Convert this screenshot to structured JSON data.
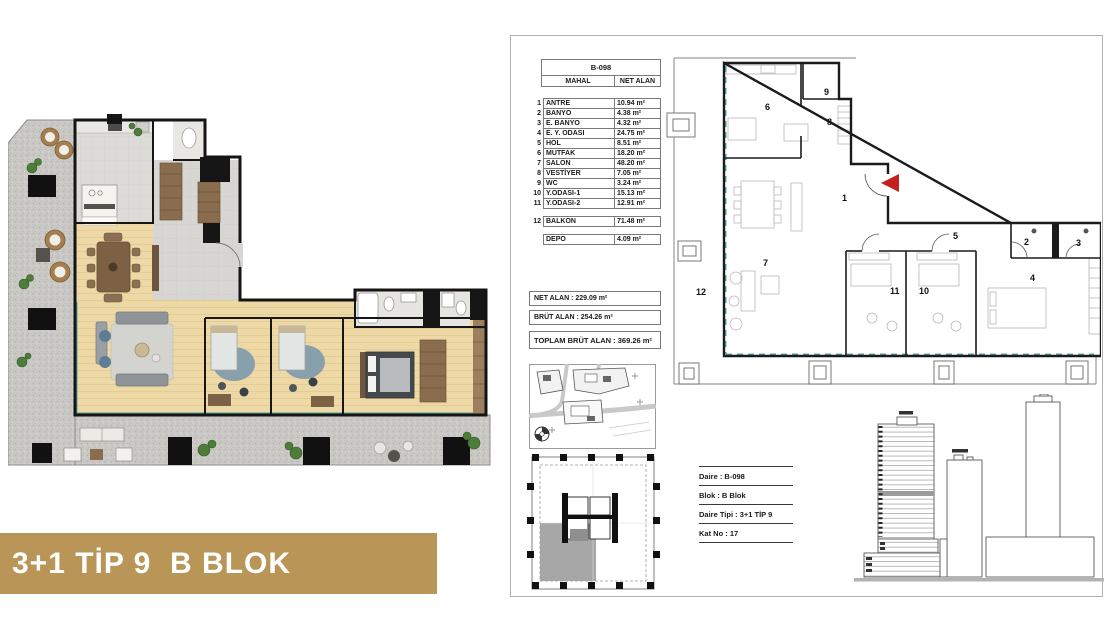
{
  "banner": {
    "label": "3+1 TİP 9  B BLOK"
  },
  "colors": {
    "banner_gold": "#b99657",
    "entry_arrow_red": "#c4201d",
    "glass_teal": "#53a7a0"
  },
  "table": {
    "code": "B-098",
    "columns": [
      "MAHAL",
      "NET ALAN"
    ],
    "rows": [
      {
        "no": "1",
        "name": "ANTRE",
        "area": "10.94 m²"
      },
      {
        "no": "2",
        "name": "BANYO",
        "area": "4.38 m²"
      },
      {
        "no": "3",
        "name": "E. BANYO",
        "area": "4.32 m²"
      },
      {
        "no": "4",
        "name": "E. Y. ODASI",
        "area": "24.75 m²"
      },
      {
        "no": "5",
        "name": "HOL",
        "area": "8.51 m²"
      },
      {
        "no": "6",
        "name": "MUTFAK",
        "area": "18.20 m²"
      },
      {
        "no": "7",
        "name": "SALON",
        "area": "48.20 m²"
      },
      {
        "no": "8",
        "name": "VESTİYER",
        "area": "7.05 m²"
      },
      {
        "no": "9",
        "name": "WC",
        "area": "3.24 m²"
      },
      {
        "no": "10",
        "name": "Y.ODASI-1",
        "area": "15.13 m²"
      },
      {
        "no": "11",
        "name": "Y.ODASI-2",
        "area": "12.91 m²"
      }
    ],
    "balkon": {
      "no": "12",
      "name": "BALKON",
      "area": "71.48 m²"
    },
    "depo": {
      "name": "DEPO",
      "area": "4.09 m²"
    }
  },
  "summary": {
    "net": "NET ALAN : 229.09 m²",
    "brut": "BRÜT ALAN : 254.26 m²",
    "toplam": "TOPLAM BRÜT ALAN : 369.26 m²"
  },
  "info": {
    "daire": "Daire : B-098",
    "blok": "Blok : B Blok",
    "tip": "Daire Tipi : 3+1 TİP 9",
    "kat": "Kat No : 17"
  },
  "tech": {
    "n1": "1",
    "n2": "2",
    "n3": "3",
    "n4": "4",
    "n5": "5",
    "n6": "6",
    "n7": "7",
    "n8": "8",
    "n9": "9",
    "n10": "10",
    "n11": "11",
    "n12": "12"
  }
}
